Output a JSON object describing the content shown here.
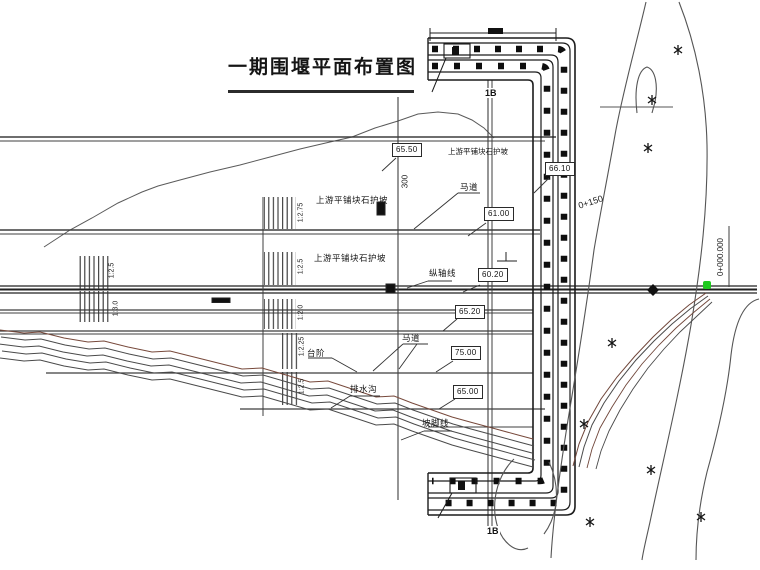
{
  "title": "一期围堰平面布置图",
  "labels": {
    "upstream_slope_protection_1": "上游平铺块石护坡",
    "upstream_slope_protection_2": "上游平铺块石护坡",
    "upstream_slope_protection_3": "上游平铺块石护坡",
    "berm_1": "马道",
    "berm_2": "马道",
    "steps": "台阶",
    "drainage_ditch": "排水沟",
    "slope_toe_line": "坡脚线",
    "axis_line": "纵轴线"
  },
  "elevations": [
    "65.50",
    "66.10",
    "61.00",
    "60.20",
    "65.20",
    "75.00",
    "65.00"
  ],
  "slopes": [
    "1:2.75",
    "1:2.5",
    "1:2.0",
    "1:2.25",
    "1:2.5",
    "1:2.5",
    "1:3.0"
  ],
  "chainage": {
    "zero": "0+000.000",
    "sta_150": "0+150"
  },
  "dimensions": {
    "crest_width": "300"
  },
  "section_markers": {
    "top": "1B",
    "bottom": "1B"
  },
  "colors": {
    "ink": "#3f3f3f",
    "dark": "#111111",
    "marker_green": "#1fca1f",
    "bank_brown": "#77493b"
  }
}
